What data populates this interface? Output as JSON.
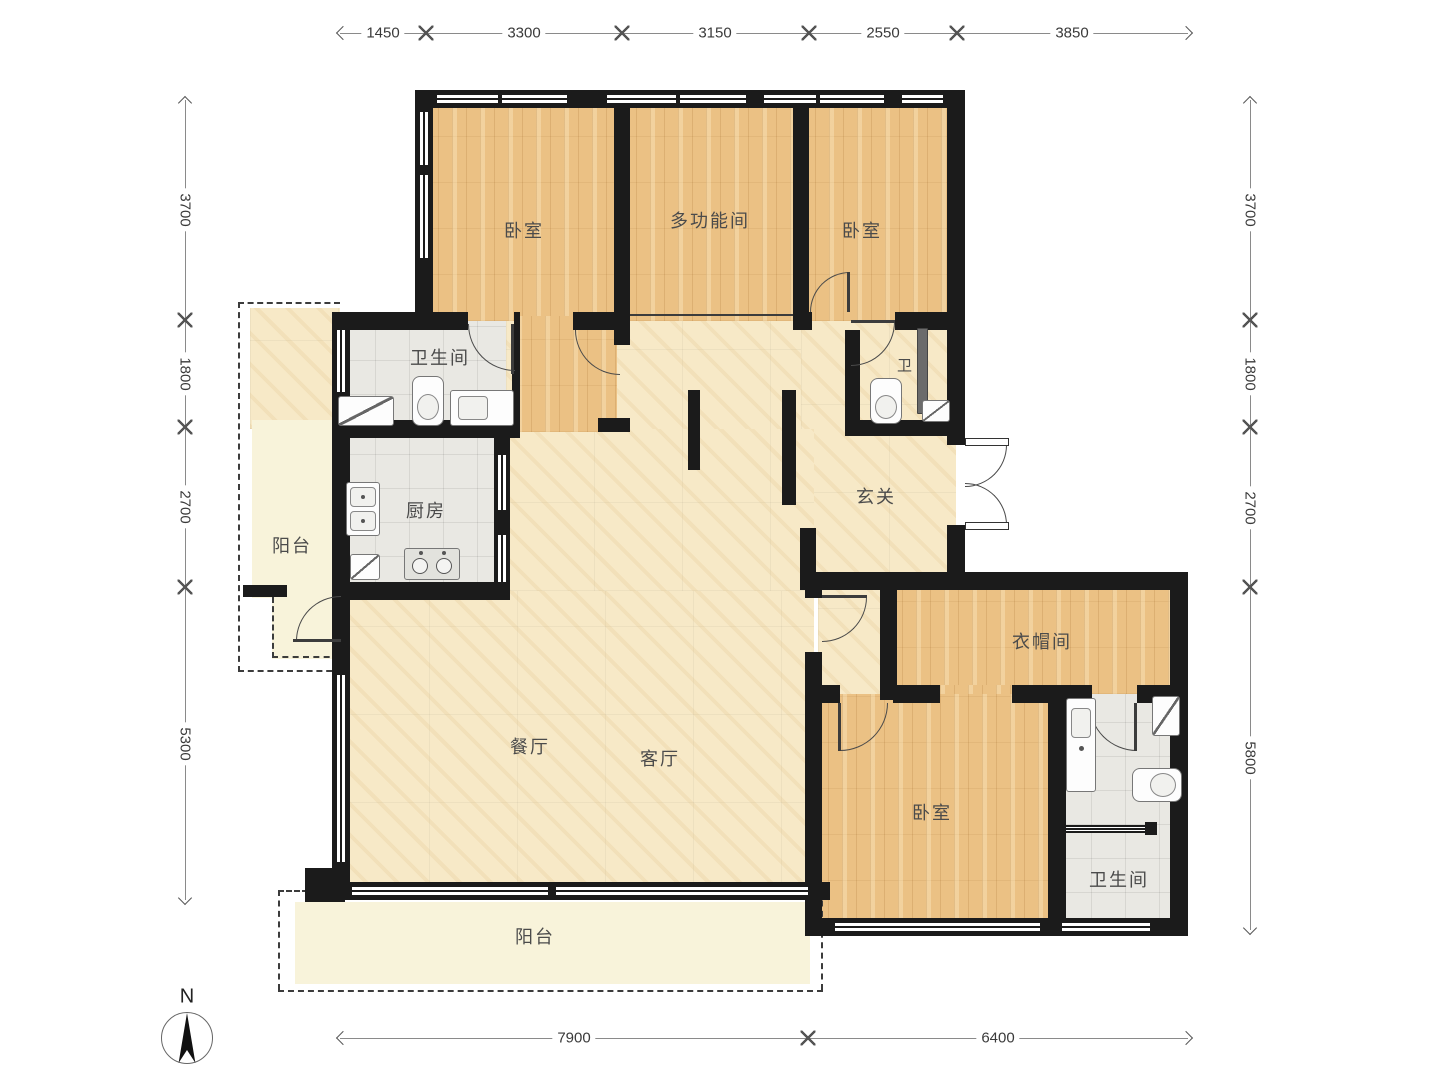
{
  "compass": {
    "north_label": "N"
  },
  "dimensions": {
    "top": [
      "1450",
      "3300",
      "3150",
      "2550",
      "3850"
    ],
    "left": [
      "3700",
      "1800",
      "2700",
      "5300"
    ],
    "right": [
      "3700",
      "1800",
      "2700",
      "5800"
    ],
    "bottom": [
      "7900",
      "6400"
    ]
  },
  "rooms": {
    "bedroom_top_left": "卧室",
    "multi_function_room": "多功能间",
    "bedroom_top_right": "卧室",
    "bathroom_main": "卫生间",
    "bathroom_small": "卫",
    "balcony_left": "阳台",
    "kitchen": "厨房",
    "entry_hall": "玄关",
    "cloakroom": "衣帽间",
    "dining_room": "餐厅",
    "living_room": "客厅",
    "bedroom_master": "卧室",
    "bathroom_master": "卫生间",
    "balcony_south": "阳台"
  },
  "colors": {
    "wall": "#1b1b1b",
    "wood_floor": "#ebc184",
    "marble_floor": "#f7e9c7",
    "tile_floor": "#e9e8e3",
    "balcony_floor": "#f8f3da",
    "dimension_line": "#8a8a8a"
  }
}
